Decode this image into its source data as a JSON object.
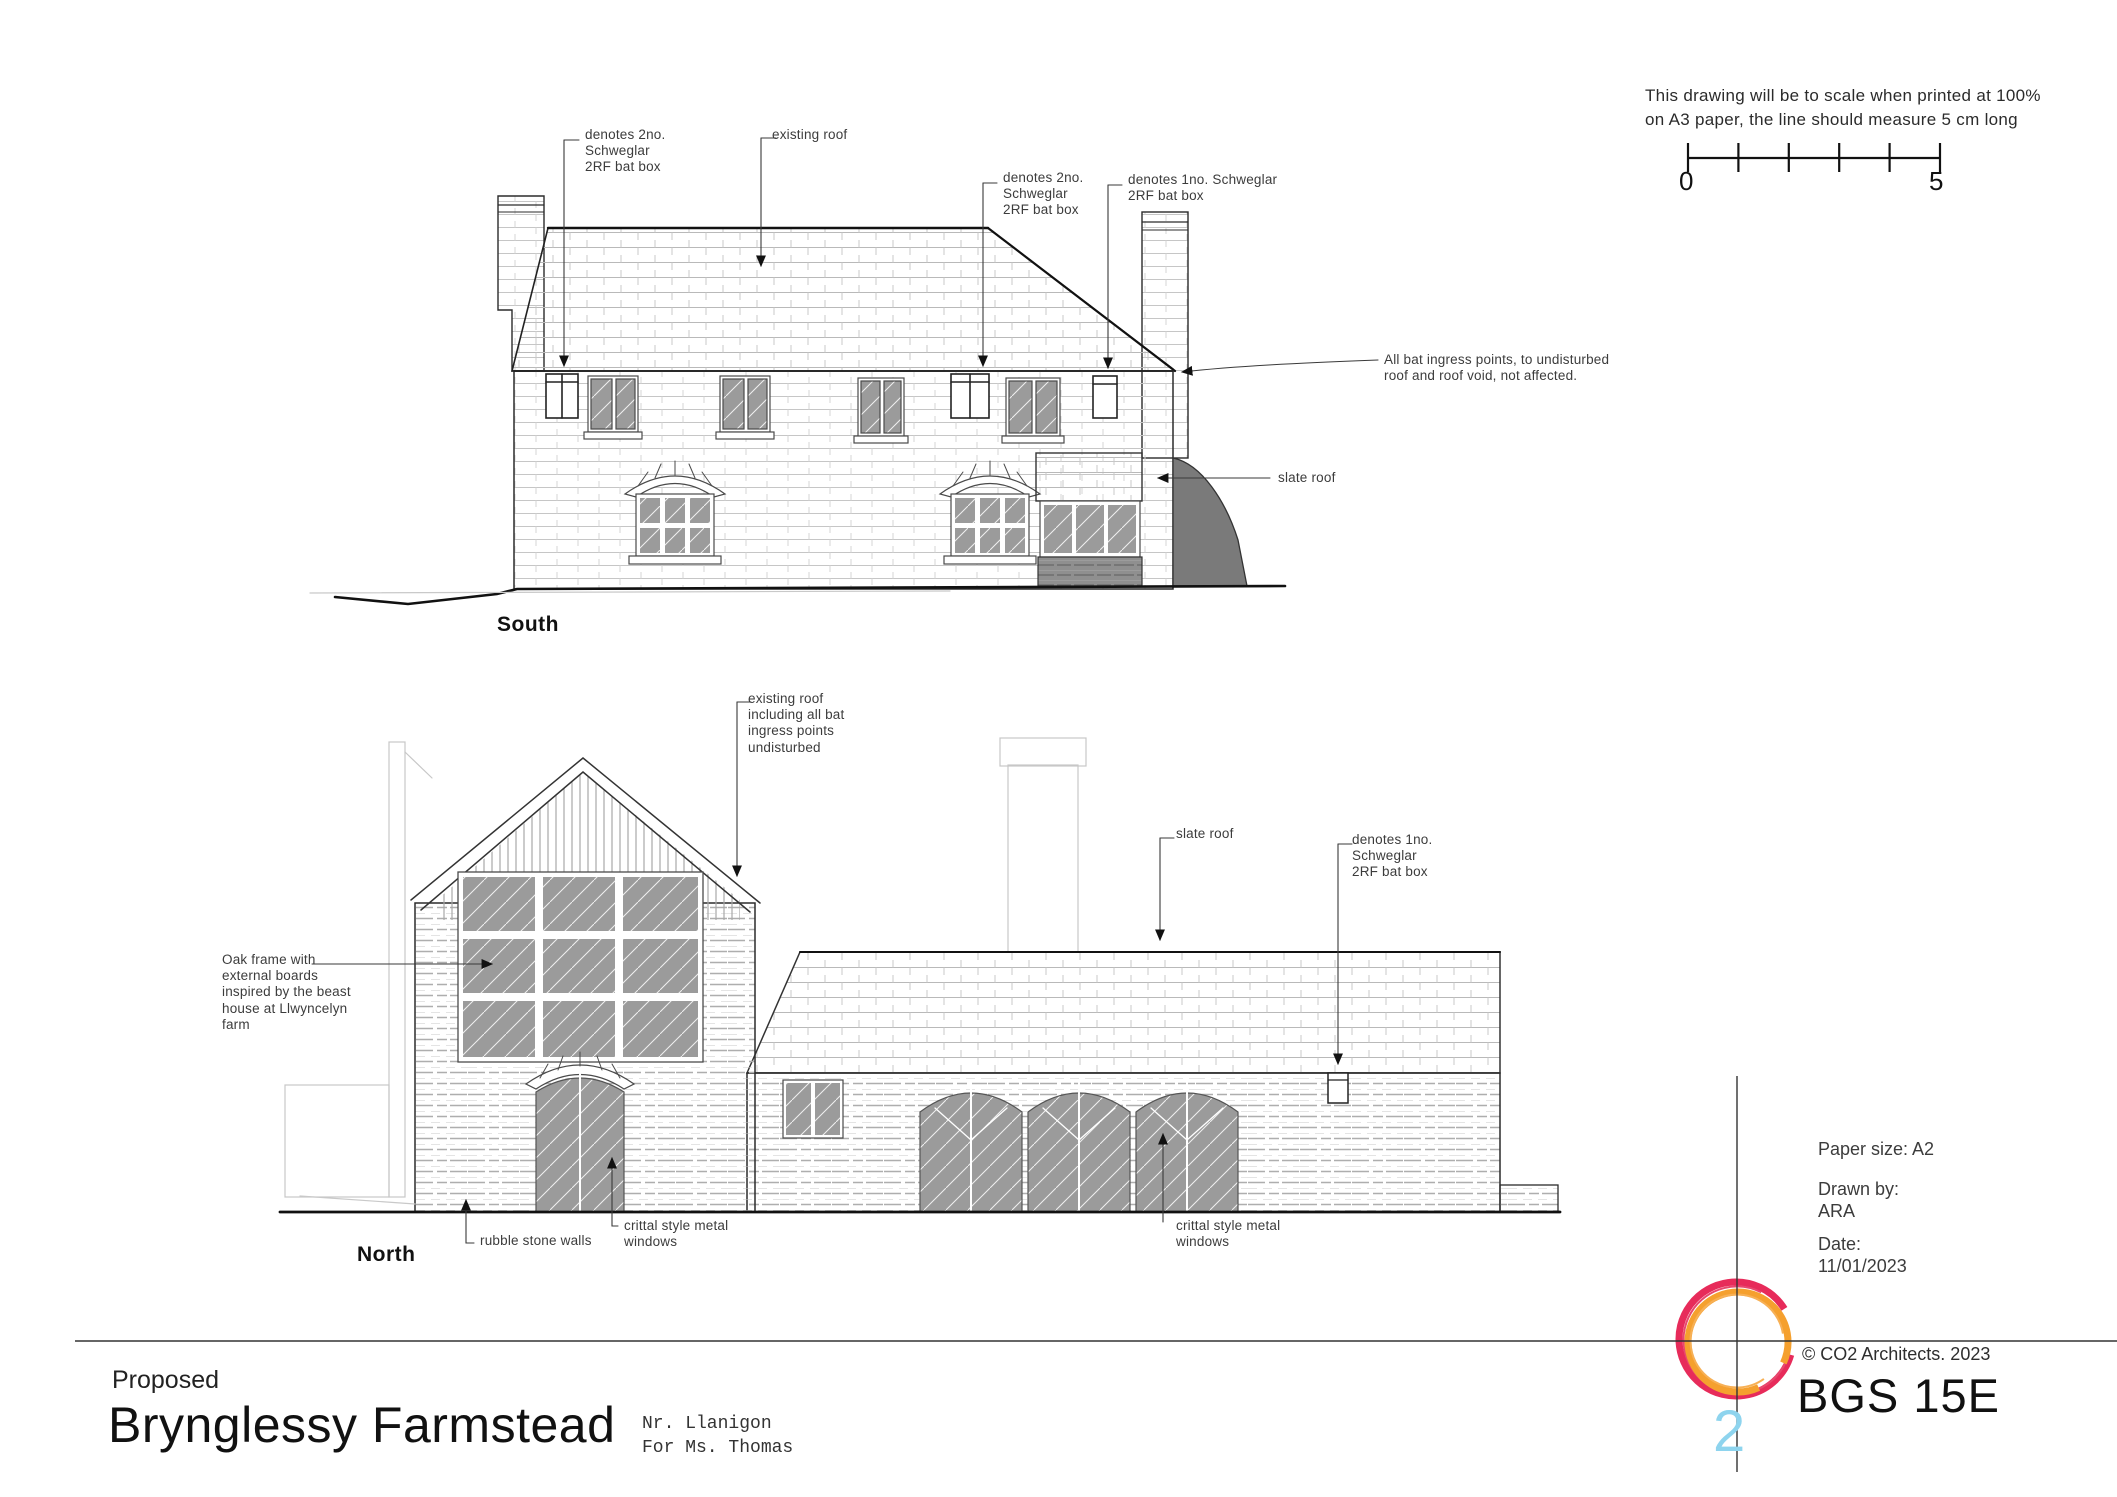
{
  "scale_block": {
    "note_line1": "This drawing will be to scale when printed at 100%",
    "note_line2": "on A3 paper, the line should measure 5 cm long",
    "start": "0",
    "end": "5"
  },
  "south": {
    "label": "South",
    "ann_batbox_2no_left": "denotes 2no.\nSchweglar\n2RF bat box",
    "ann_existing_roof": "existing roof",
    "ann_batbox_2no_right": "denotes 2no.\nSchweglar\n2RF bat box",
    "ann_batbox_1no": "denotes 1no. Schweglar\n2RF bat box",
    "ann_ingress": "All bat ingress points, to undisturbed\nroof and roof void, not affected.",
    "ann_slate_roof": "slate roof"
  },
  "north": {
    "label": "North",
    "ann_existing_roof": "existing roof\nincluding all bat\ningress points\nundisturbed",
    "ann_slate_roof": "slate roof",
    "ann_batbox_1no": "denotes 1no.\nSchweglar\n2RF bat box",
    "ann_oak_frame": "Oak frame with\nexternal boards\ninspired by the beast\nhouse at Llwyncelyn\nfarm",
    "ann_rubble": "rubble stone walls",
    "ann_crittal_left": "crittal style metal\nwindows",
    "ann_crittal_right": "crittal style metal\nwindows"
  },
  "titleblock": {
    "project_status": "Proposed",
    "project_name": "Brynglessy Farmstead",
    "location": "Nr. Llanigon",
    "client": "For Ms. Thomas",
    "paper_size": "Paper size: A2",
    "drawn_by_label": "Drawn by:",
    "drawn_by": "ARA",
    "date_label": "Date:",
    "date": "11/01/2023",
    "copyright": "© CO2 Architects. 2023",
    "drawing_number": "BGS 15E",
    "logo_number": "2"
  },
  "colors": {
    "line": "#2b2b2b",
    "hatch": "#c2c2c2",
    "pane": "#9b9b9b",
    "logo_orange": "#f5a02e",
    "logo_pink": "#e72b5a",
    "logo_blue": "#8ed4ee"
  }
}
